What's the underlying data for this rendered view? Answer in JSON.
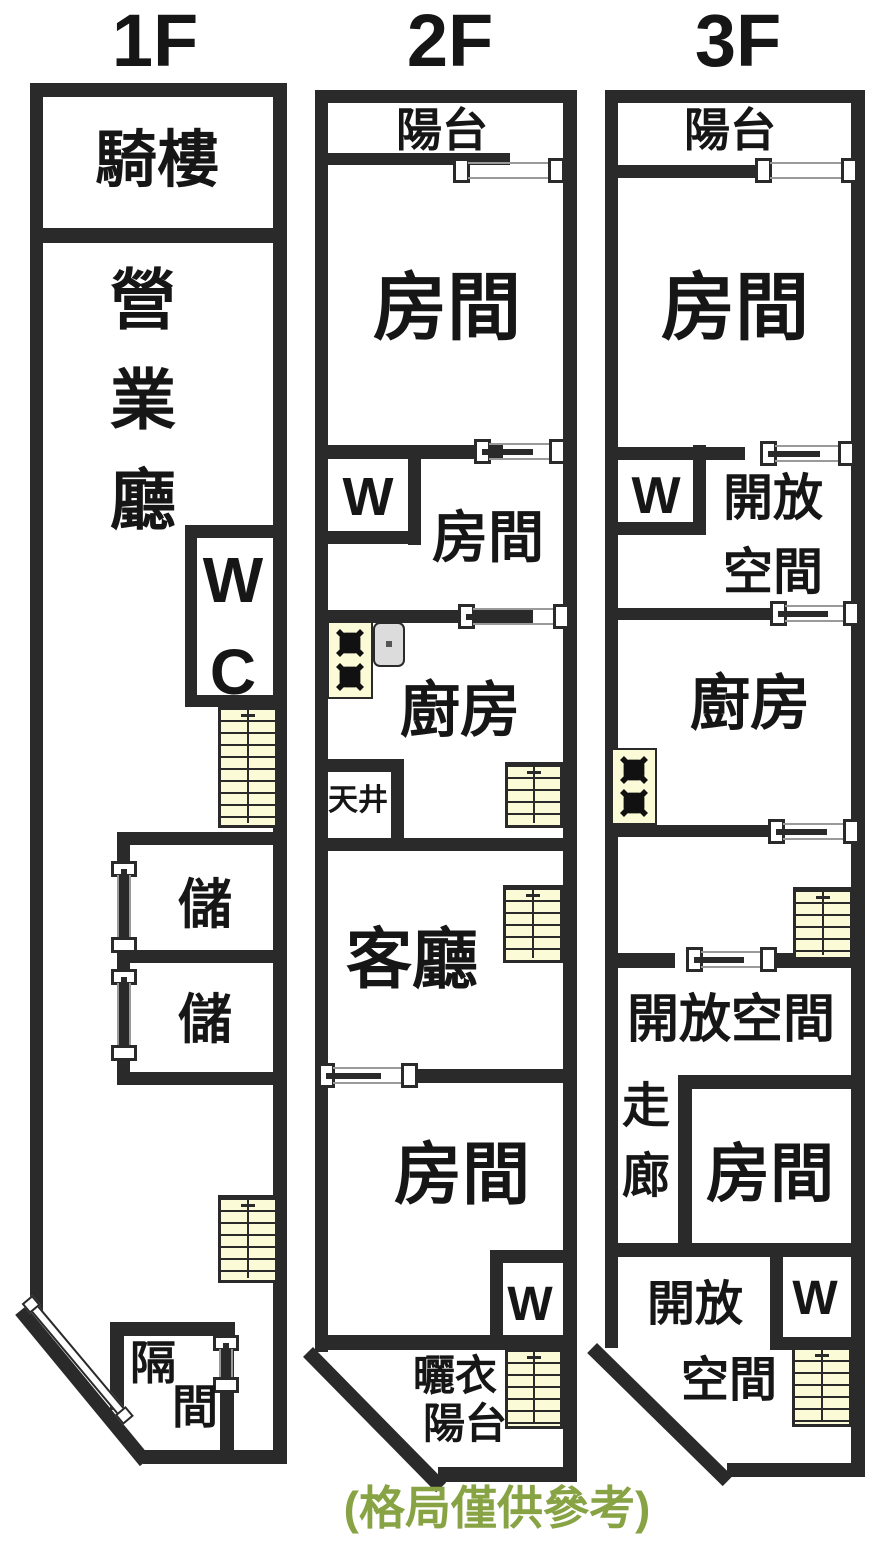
{
  "note": "(格局僅供參考)",
  "colors": {
    "wall": "#2a2a2a",
    "stairs_fill": "#FBFBD8",
    "sink_gray": "#DCDCDC",
    "note_green": "#87A344",
    "text": "#161616"
  },
  "floors": [
    {
      "title": "1F",
      "rooms": {
        "qilou": "騎樓",
        "yingyeting": "營業廳",
        "wc": "WC",
        "storage1": "儲",
        "storage2": "儲",
        "gejian_char1": "隔",
        "gejian_char2": "間"
      }
    },
    {
      "title": "2F",
      "rooms": {
        "balcony": "陽台",
        "room1": "房間",
        "closet1": "W",
        "room2": "房間",
        "kitchen": "廚房",
        "tianjing": "天井",
        "living": "客廳",
        "room3": "房間",
        "closet2": "W",
        "laundry_line1": "曬衣",
        "laundry_line2": "陽台"
      }
    },
    {
      "title": "3F",
      "rooms": {
        "balcony": "陽台",
        "room1": "房間",
        "closet1": "W",
        "open1_line1": "開放",
        "open1_line2": "空間",
        "kitchen": "廚房",
        "open2": "開放空間",
        "corridor": "走廊",
        "room2": "房間",
        "open3_line1": "開放",
        "open3_line2": "空間",
        "closet2": "W"
      }
    }
  ]
}
